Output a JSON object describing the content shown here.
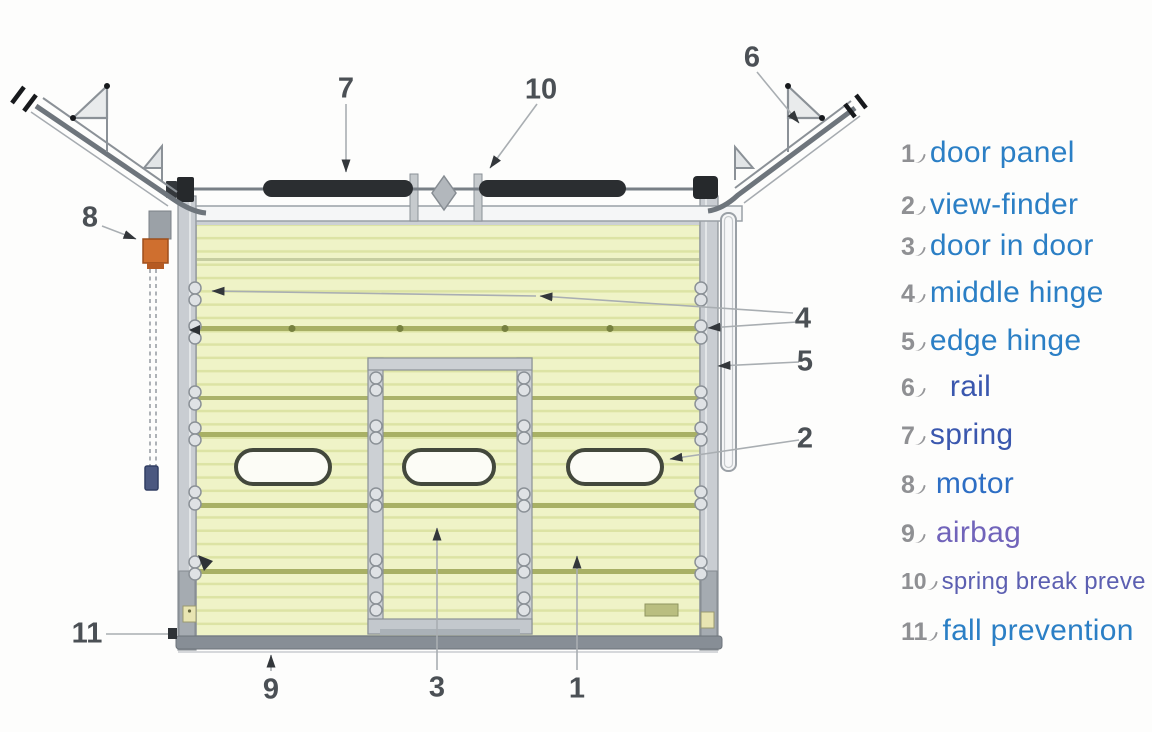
{
  "legend": {
    "items": [
      {
        "num": "1",
        "label": "door panel",
        "color": "#2b7fc5"
      },
      {
        "num": "2",
        "label": "view-finder",
        "color": "#2b7fc5"
      },
      {
        "num": "3",
        "label": "door in door",
        "color": "#2b7fc5"
      },
      {
        "num": "4",
        "label": "middle hinge",
        "color": "#2b7fc5"
      },
      {
        "num": "5",
        "label": "edge hinge",
        "color": "#2b7fc5"
      },
      {
        "num": "6",
        "label": "rail",
        "color": "#3a57ae"
      },
      {
        "num": "7",
        "label": "spring",
        "color": "#3a57ae"
      },
      {
        "num": "8",
        "label": "motor",
        "color": "#2d6ec4"
      },
      {
        "num": "9",
        "label": "airbag",
        "color": "#7164ba"
      },
      {
        "num": "10",
        "label": "spring break preve",
        "color": "#5c5fb1"
      },
      {
        "num": "11",
        "label": "fall prevention",
        "color": "#2b7fc5"
      }
    ],
    "number_color": "#8f9093"
  },
  "callouts": {
    "n1": "1",
    "n2": "2",
    "n3": "3",
    "n4": "4",
    "n5": "5",
    "n6": "6",
    "n7": "7",
    "n8": "8",
    "n9": "9",
    "n10": "10",
    "n11": "11"
  },
  "diagram": {
    "subject": "sectional overhead garage door exploded view",
    "colors": {
      "panel_fill": "#eff3c7",
      "panel_stripe": "#dce3a4",
      "seam_olive": "#a8b065",
      "frame_gray": "#c9cdd2",
      "spring_black": "#2b2e31",
      "motor_orange": "#cf6f2f",
      "handle_blue": "#4b5880",
      "callout_gray": "#a9aeb2"
    }
  }
}
